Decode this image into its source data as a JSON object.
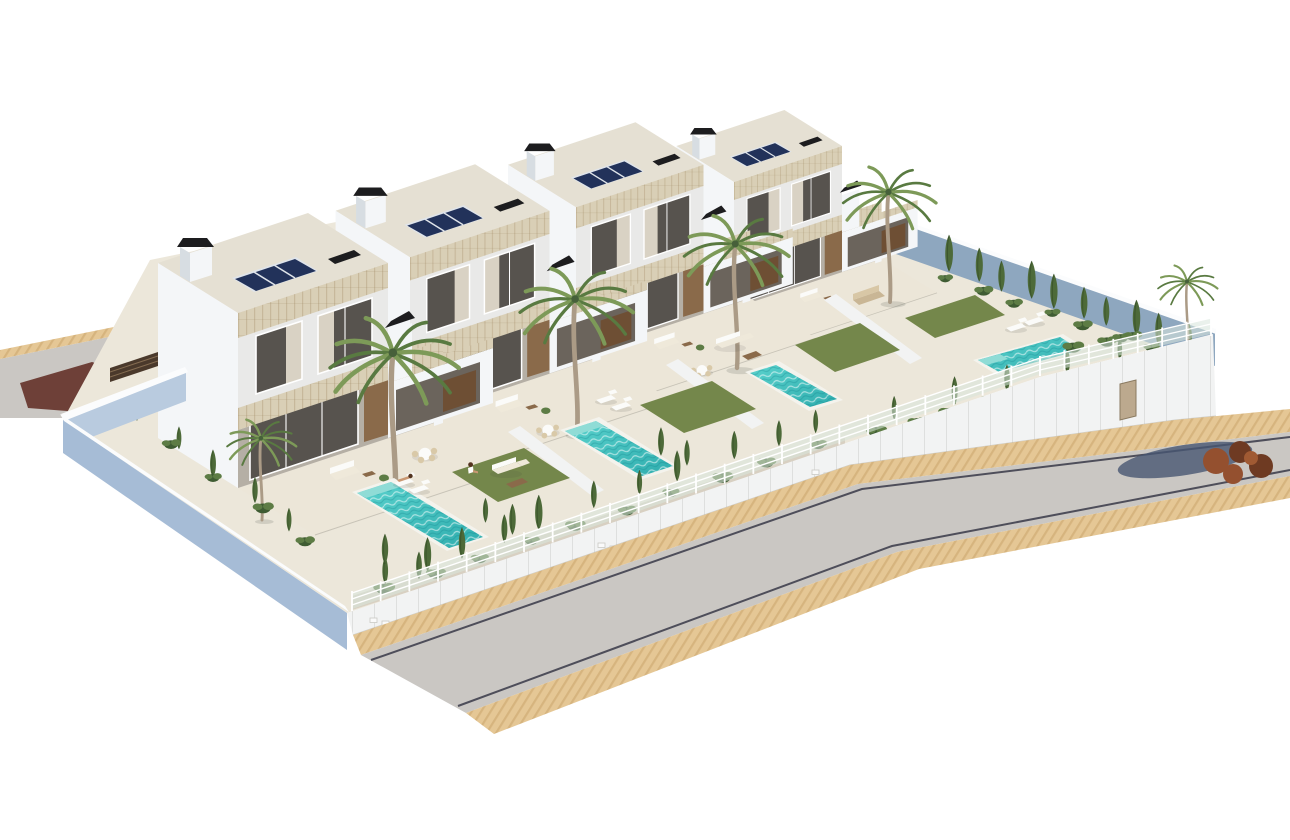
{
  "meta": {
    "type": "3d-architectural-render",
    "subject": "row of four modern two-storey villas with private pools and gardens",
    "view": "aerial isometric",
    "background": "#ffffff"
  },
  "palette": {
    "bg": "#ffffff",
    "building_white": "#f4f6f8",
    "building_side": "#e9e9e8",
    "building_shadow": "#b5afa5",
    "roof_top": "#e5e0d3",
    "left_face_blue": "#ccd7e4",
    "perimeter_blue": "#a6bcd6",
    "perimeter_blue_light": "#b9cbdf",
    "ne_wall_blue": "#8ea7bf",
    "wall_white": "#f2f3f3",
    "cap_white": "#fbfcfd",
    "travertine": "#d9cfb6",
    "travertine_streak": "#b9a884",
    "glass_dark": "#57534e",
    "glass_frame": "#ffffff",
    "curtain": "#d9d2c4",
    "wood": "#8a6a4a",
    "wood_dark": "#6e4f34",
    "porch_opening": "#6b645c",
    "solar_frame": "#dfe4ea",
    "solar_cell": "#22325a",
    "chimney_black": "#1d1d1f",
    "terrace_floor": "#ece6d8",
    "plot_base": "#ece7da",
    "pool_coping": "#f4f3ed",
    "pool_water_top": "#4ccbc7",
    "pool_water_deep": "#2fadae",
    "pool_steps": "#8fdcd6",
    "lawn": "#74874b",
    "gravel": "#d8d0c2",
    "shrub_dark": "#3f5c33",
    "shrub_green": "#5d7c45",
    "cypress": "#4d6a39",
    "palm_green": "#7d9a58",
    "palm_green_dark": "#597a41",
    "palm_trunk": "#ab9b86",
    "fence_panel": "#d9e5dc",
    "fence_white": "#ffffff",
    "sidewalk": "#e5c795",
    "sidewalk_stripe": "#d6b47e",
    "road": "#cac7c3",
    "curb": "#4e4e5a",
    "red_patch": "#6e4038",
    "slat_gate": "#4a392b",
    "tree_canopy": "#94502f",
    "tree_canopy_dark": "#6e3a22",
    "tree_shadow": "#475672",
    "skin": "#c99873",
    "hair": "#53331f",
    "lounger_white": "#fbfbf9",
    "cushion_cream": "#efe9da",
    "gate_door": "#bca98e"
  },
  "scene": {
    "villas": [
      {
        "name": "villa-1",
        "solar_modules": 3,
        "chimneys": 2,
        "palms": 2,
        "pool": "rectangular",
        "lawn": true,
        "furniture": [
          "dining-set",
          "sun-loungers",
          "outdoor-sofa",
          "coffee-table"
        ],
        "people": 2
      },
      {
        "name": "villa-2",
        "solar_modules": 3,
        "chimneys": 2,
        "palms": 1,
        "pool": "rectangular",
        "lawn": true,
        "furniture": [
          "dining-set",
          "sun-loungers",
          "outdoor-sofa"
        ],
        "people": 0
      },
      {
        "name": "villa-3",
        "solar_modules": 3,
        "chimneys": 2,
        "palms": 1,
        "pool": "rectangular",
        "lawn": true,
        "furniture": [
          "dining-set",
          "outdoor-sofa",
          "coffee-table"
        ],
        "people": 0
      },
      {
        "name": "villa-4",
        "solar_modules": 3,
        "chimneys": 2,
        "palms": 2,
        "pool": "rectangular-wide",
        "lawn": true,
        "furniture": [
          "outdoor-sofa",
          "sun-loungers"
        ],
        "people": 0,
        "hedge_cypresses": 10
      }
    ],
    "road": {
      "surface": "light asphalt",
      "bend": true,
      "curb_lines": 2,
      "sidewalks": "tan pavers both sides"
    },
    "perimeter": {
      "front_wall": "white with glass-and-rail fence",
      "left_wall": "slate blue",
      "rear_right_wall": "slate blue inner face"
    },
    "fence": {
      "rails": 3,
      "segments": [
        {
          "x1": 352,
          "y1": 611,
          "x2": 1040,
          "y2": 376,
          "posts": 24
        },
        {
          "x1": 1040,
          "y1": 376,
          "x2": 1211,
          "y2": 336,
          "posts": 7
        }
      ]
    },
    "planting": [
      {
        "type": "cypress",
        "x1": 368,
        "y1": 592,
        "x2": 560,
        "y2": 523,
        "count": 5,
        "scale": 1.0
      },
      {
        "type": "cypress",
        "x1": 575,
        "y1": 516,
        "x2": 700,
        "y2": 473,
        "count": 3,
        "scale": 0.9
      },
      {
        "type": "cypress",
        "x1": 716,
        "y1": 467,
        "x2": 838,
        "y2": 425,
        "count": 3,
        "scale": 0.85
      },
      {
        "type": "shrub",
        "x1": 362,
        "y1": 598,
        "x2": 840,
        "y2": 438,
        "count": 10,
        "scale": 1.0
      },
      {
        "type": "cypress",
        "x1": 868,
        "y1": 428,
        "x2": 1150,
        "y2": 352,
        "count": 5,
        "scale": 0.8
      },
      {
        "type": "shrub",
        "x1": 860,
        "y1": 438,
        "x2": 1190,
        "y2": 346,
        "count": 9,
        "scale": 1.1
      },
      {
        "type": "cypress",
        "x1": 938,
        "y1": 268,
        "x2": 1200,
        "y2": 358,
        "count": 10,
        "scale": 1.05
      },
      {
        "type": "shrub",
        "x1": 930,
        "y1": 274,
        "x2": 1205,
        "y2": 366,
        "count": 8,
        "scale": 0.9
      },
      {
        "type": "cypress",
        "x1": 120,
        "y1": 408,
        "x2": 310,
        "y2": 545,
        "count": 5,
        "scale": 0.8
      },
      {
        "type": "shrub",
        "x1": 100,
        "y1": 396,
        "x2": 330,
        "y2": 558,
        "count": 5,
        "scale": 1.0
      },
      {
        "type": "cypress",
        "x1": 476,
        "y1": 518,
        "x2": 522,
        "y2": 540,
        "count": 2,
        "scale": 0.9
      },
      {
        "type": "cypress",
        "x1": 372,
        "y1": 558,
        "x2": 432,
        "y2": 586,
        "count": 2,
        "scale": 1.0
      },
      {
        "type": "cypress",
        "x1": 652,
        "y1": 452,
        "x2": 696,
        "y2": 470,
        "count": 2,
        "scale": 0.85
      },
      {
        "type": "shrub",
        "x1": 1060,
        "y1": 352,
        "x2": 1150,
        "y2": 332,
        "count": 3,
        "scale": 1.0
      }
    ]
  }
}
